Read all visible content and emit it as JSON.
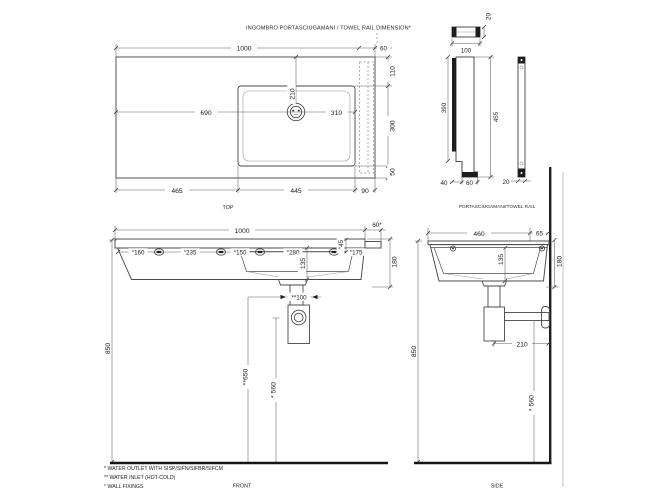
{
  "header": {
    "title": "INGOMBRO PORTASCIUGAMANI / TOWEL RAIL DIMENSION*"
  },
  "top_view": {
    "caption": "TOP",
    "width": "1000",
    "rail_width": "60",
    "back_offset": "110",
    "basin_depth": "300",
    "front_offset": "50",
    "left_section": "465",
    "basin_width": "445",
    "right_section": "90",
    "faucet_from_left": "690",
    "faucet_from_right": "310",
    "faucet_from_back": "210"
  },
  "towel_rail": {
    "caption": "PORTASCIUGAMANI/TOWEL RAIL",
    "profile_thickness": "20",
    "length": "100",
    "upper_height": "390",
    "total_height": "455",
    "foot_inset": "40",
    "foot_width": "60",
    "bar_width": "20"
  },
  "front_view": {
    "caption": "FRONT",
    "width": "1000",
    "rail_overhang": "60*",
    "fixing_spacings": [
      "°160",
      "°235",
      "°150",
      "°280",
      "°175"
    ],
    "rim_height": "°45",
    "bowl_height": "135",
    "total_height": "180",
    "mount_height": "850",
    "inlet_spacing": "**100",
    "inlet_height": "**650",
    "outlet_height": "* 560"
  },
  "side_view": {
    "caption": "SIDE",
    "depth": "460",
    "wall_offset": "65",
    "bowl_height": "135",
    "total_height": "180",
    "mount_height": "850",
    "outlet_wall_distance": "210",
    "outlet_height": "* 560"
  },
  "notes": {
    "outlet": "* WATER OUTLET WITH SISP/SIFN/SIFBR/SIFCM",
    "inlet": "** WATER INLET  (HOT-COLD)",
    "fixings": "° WALL FIXINGS"
  },
  "colors": {
    "line": "#4a4a4a",
    "text": "#1b1b1b",
    "wall": "#151515",
    "light": "#9a9a9a"
  }
}
